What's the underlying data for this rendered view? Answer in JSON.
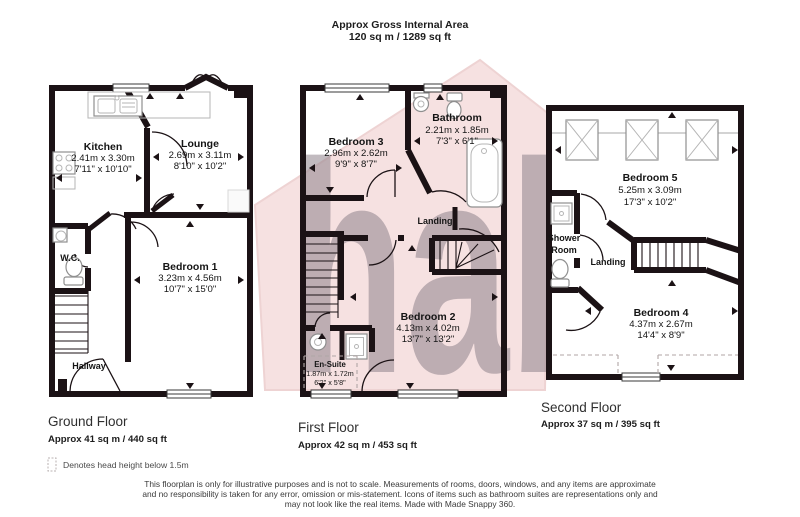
{
  "title": {
    "line1": "Approx Gross Internal Area",
    "line2": "120 sq m / 1289 sq ft"
  },
  "watermark": {
    "text": "habi"
  },
  "colors": {
    "wall": "#1b1215",
    "watermark_house": "#f6e1e1",
    "watermark_text": "#90838c",
    "fixture_gray": "#8f8f8f"
  },
  "floors": {
    "ground": {
      "label": "Ground Floor",
      "area": "Approx 41 sq m / 440 sq ft",
      "rooms": {
        "kitchen": {
          "name": "Kitchen",
          "metric": "2.41m x 3.30m",
          "imperial": "7'11\" x 10'10\""
        },
        "lounge": {
          "name": "Lounge",
          "metric": "2.69m x 3.11m",
          "imperial": "8'10\" x 10'2\""
        },
        "wc": {
          "name": "W.C."
        },
        "bedroom1": {
          "name": "Bedroom 1",
          "metric": "3.23m x 4.56m",
          "imperial": "10'7\" x 15'0\""
        },
        "hallway": {
          "name": "Hallway"
        }
      }
    },
    "first": {
      "label": "First Floor",
      "area": "Approx 42 sq m / 453 sq ft",
      "rooms": {
        "bedroom3": {
          "name": "Bedroom 3",
          "metric": "2.96m x 2.62m",
          "imperial": "9'9\" x 8'7\""
        },
        "bathroom": {
          "name": "Bathroom",
          "metric": "2.21m x 1.85m",
          "imperial": "7'3\" x 6'1\""
        },
        "landing": {
          "name": "Landing"
        },
        "bedroom2": {
          "name": "Bedroom 2",
          "metric": "4.13m x 4.02m",
          "imperial": "13'7\" x 13'2\""
        },
        "ensuite": {
          "name": "En-Suite",
          "metric": "1.87m x 1.72m",
          "imperial": "6'2\" x 5'8\""
        }
      }
    },
    "second": {
      "label": "Second Floor",
      "area": "Approx 37 sq m / 395 sq ft",
      "rooms": {
        "bedroom5": {
          "name": "Bedroom 5",
          "metric": "5.25m x 3.09m",
          "imperial": "17'3\" x 10'2\""
        },
        "shower1": {
          "name": "Shower"
        },
        "shower2": {
          "name": "Room"
        },
        "landing": {
          "name": "Landing"
        },
        "bedroom4": {
          "name": "Bedroom 4",
          "metric": "4.37m x 2.67m",
          "imperial": "14'4\" x 8'9\""
        }
      }
    }
  },
  "legend": {
    "text": "Denotes head height below 1.5m"
  },
  "footer": {
    "line1": "This floorplan is only for illustrative purposes and is not to scale. Measurements of rooms, doors, windows, and any items are approximate",
    "line2": "and no responsibility is taken for any error, omission or mis-statement. Icons of items such as bathroom suites are representations only and",
    "line3": "may not look like the real items. Made with Made Snappy 360."
  }
}
